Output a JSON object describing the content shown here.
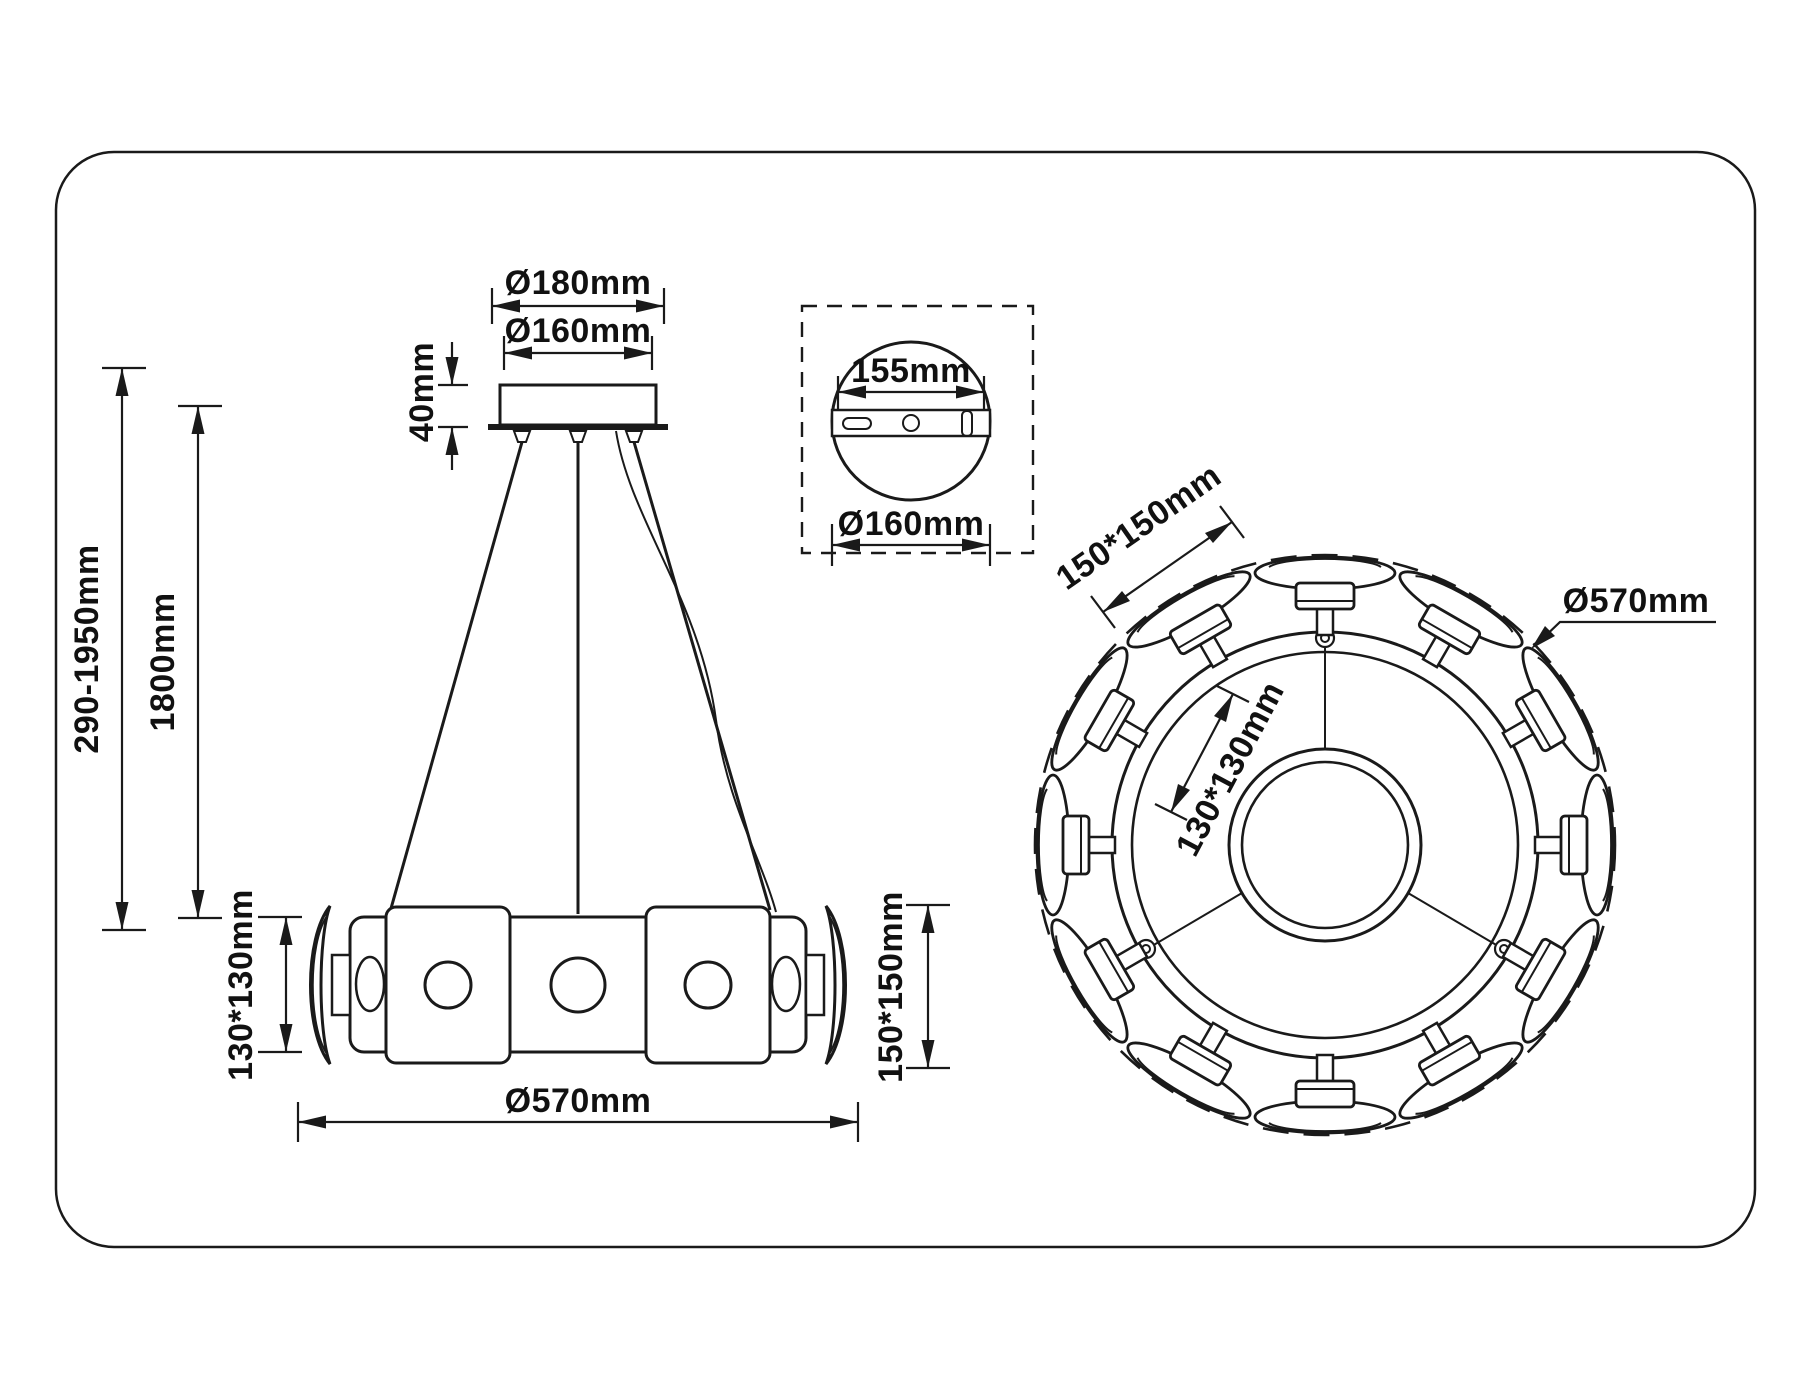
{
  "drawing": {
    "side_view": {
      "canopy_outer_diameter": "Ø180mm",
      "canopy_plate_diameter": "Ø160mm",
      "canopy_height": "40mm",
      "overall_height_range": "290-1950mm",
      "suspension_length": "1800mm",
      "ring_profile_size": "130*130mm",
      "shade_size": "150*150mm",
      "ring_diameter": "Ø570mm"
    },
    "canopy_detail": {
      "bracket_length": "155mm",
      "plate_diameter": "Ø160mm"
    },
    "top_view": {
      "shade_size": "150*150mm",
      "ring_diameter": "Ø570mm",
      "hub_size": "130*130mm"
    }
  }
}
